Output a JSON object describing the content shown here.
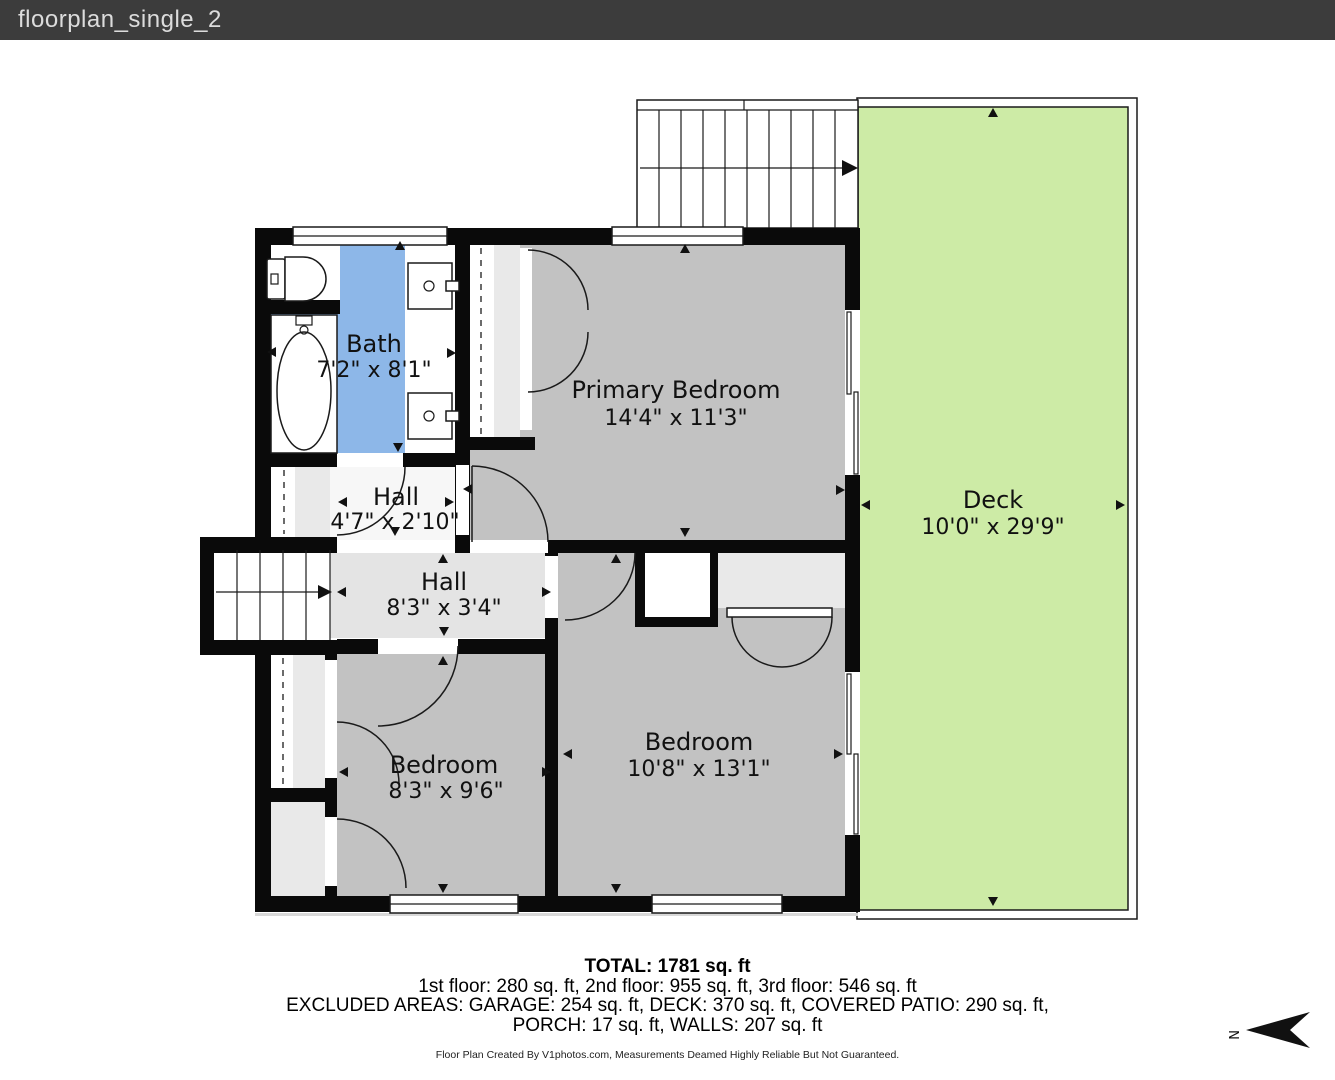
{
  "header": {
    "title": "floorplan_single_2"
  },
  "rooms": {
    "bath": {
      "name": "Bath",
      "dims": "7'2\" x 8'1\""
    },
    "primary_bedroom": {
      "name": "Primary Bedroom",
      "dims": "14'4\" x 11'3\""
    },
    "deck": {
      "name": "Deck",
      "dims": "10'0\" x 29'9\""
    },
    "hall_upper": {
      "name": "Hall",
      "dims": "4'7\" x 2'10\""
    },
    "hall_lower": {
      "name": "Hall",
      "dims": "8'3\" x 3'4\""
    },
    "bedroom_left": {
      "name": "Bedroom",
      "dims": "8'3\" x 9'6\""
    },
    "bedroom_right": {
      "name": "Bedroom",
      "dims": "10'8\" x 13'1\""
    }
  },
  "footer": {
    "total": "TOTAL: 1781 sq. ft",
    "floors": "1st floor: 280 sq. ft, 2nd floor: 955 sq. ft, 3rd floor: 546 sq. ft",
    "excluded": "EXCLUDED AREAS: GARAGE: 254 sq. ft, DECK: 370 sq. ft, COVERED PATIO: 290 sq. ft,",
    "excluded2": "PORCH: 17 sq. ft, WALLS: 207 sq. ft",
    "disclaimer": "Floor Plan Created By V1photos.com, Measurements Deamed Highly Reliable But Not Guaranteed.",
    "north_label": "N"
  },
  "colors": {
    "header_bg": "#3c3c3c",
    "header_text": "#dcdcdc",
    "wall": "#0a0a0a",
    "room_gray": "#c2c2c2",
    "hall_gray": "#e4e4e4",
    "bath_blue": "#8db7e8",
    "deck_green": "#cdeba6"
  }
}
